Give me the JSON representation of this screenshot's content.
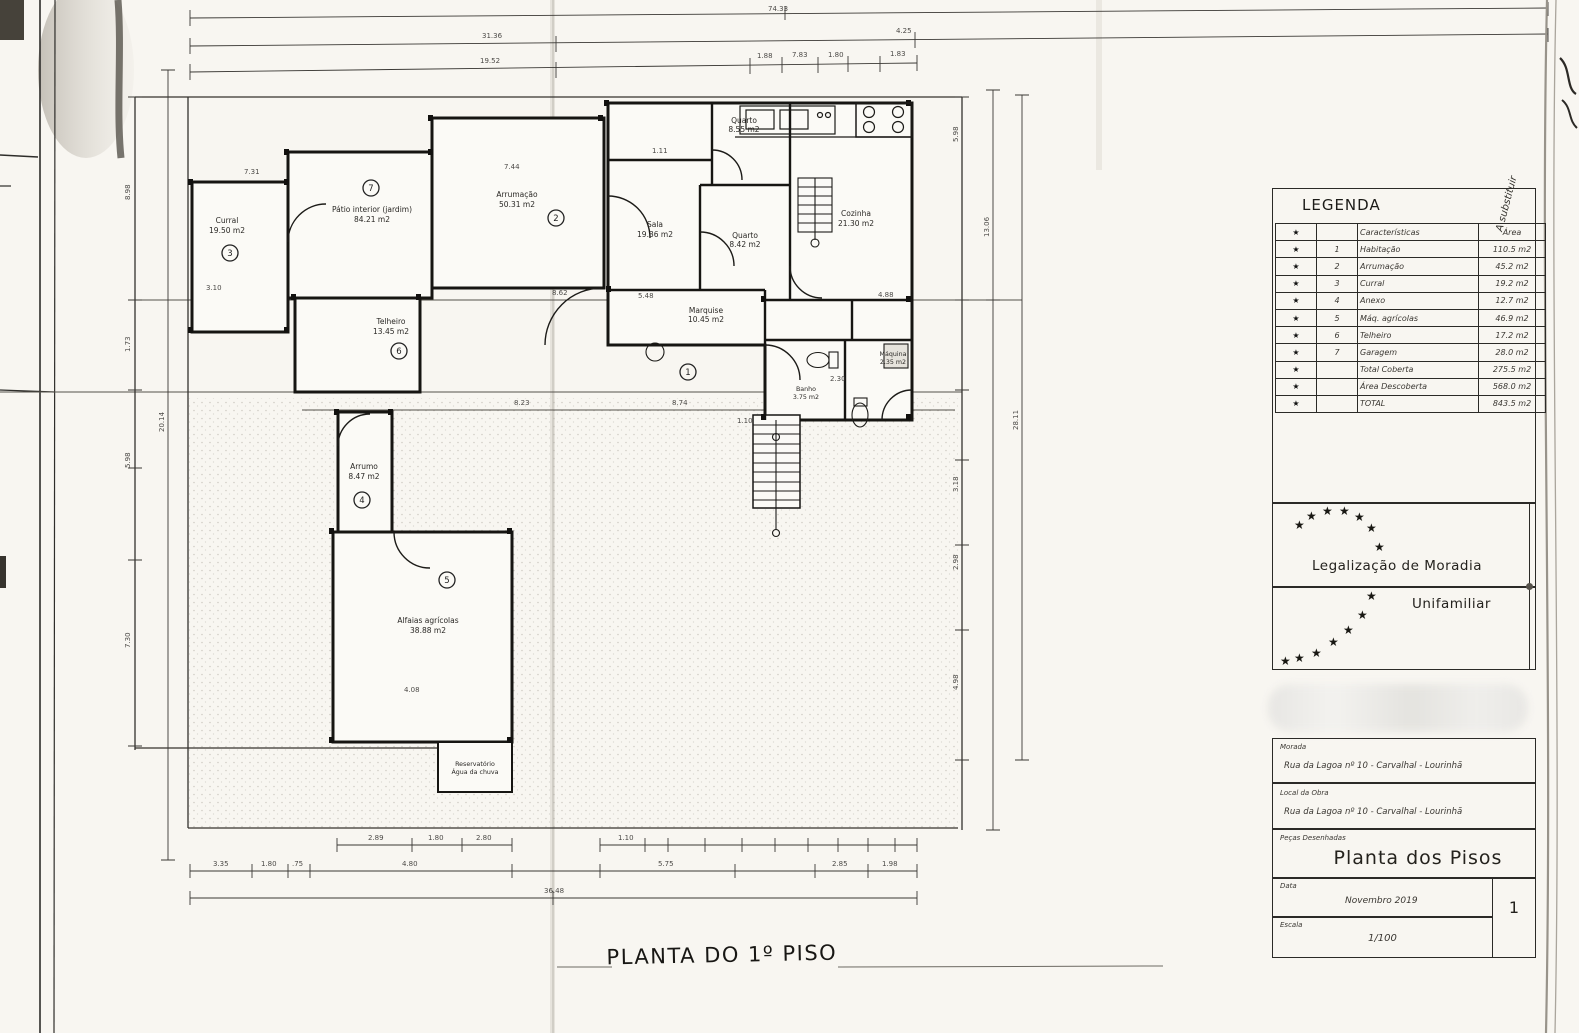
{
  "document": {
    "main_title": "PLANTA DO 1º PISO",
    "annotation": "A substituir"
  },
  "legend": {
    "title": "LEGENDA",
    "star": "★",
    "header": {
      "num": "",
      "name": "Características",
      "area": "Área"
    },
    "rows": [
      {
        "num": "1",
        "name": "Habitação",
        "area": "110.5 m2"
      },
      {
        "num": "2",
        "name": "Arrumação",
        "area": "45.2 m2"
      },
      {
        "num": "3",
        "name": "Curral",
        "area": "19.2 m2"
      },
      {
        "num": "4",
        "name": "Anexo",
        "area": "12.7 m2"
      },
      {
        "num": "5",
        "name": "Máq. agrícolas",
        "area": "46.9 m2"
      },
      {
        "num": "6",
        "name": "Telheiro",
        "area": "17.2 m2"
      },
      {
        "num": "7",
        "name": "Garagem",
        "area": "28.0 m2"
      },
      {
        "num": "",
        "name": "Total Coberta",
        "area": "275.5 m2"
      },
      {
        "num": "",
        "name": "Área Descoberta",
        "area": "568.0 m2"
      },
      {
        "num": "",
        "name": "TOTAL",
        "area": "843.5 m2"
      }
    ]
  },
  "stamp": {
    "star": "★",
    "line1": "Legalização de Moradia",
    "line2": "Unifamiliar"
  },
  "title_block": {
    "morada_label": "Morada",
    "morada_value": "Rua da Lagoa nº 10  -  Carvalhal  -  Lourinhã",
    "local_label": "Local da Obra",
    "local_value": "Rua da Lagoa nº 10  -  Carvalhal  -  Lourinhã",
    "pecas_label": "Peças Desenhadas",
    "pecas_value": "Planta dos Pisos",
    "data_label": "Data",
    "data_value": "Novembro 2019",
    "escala_label": "Escala",
    "escala_value": "1/100",
    "sheet_number": "1"
  },
  "rooms": [
    {
      "name": "Curral",
      "area": "19.50 m2",
      "num": "3"
    },
    {
      "name": "Pátio interior (jardim)",
      "area": "84.21 m2",
      "num": "7"
    },
    {
      "name": "Arrumação",
      "area": "50.31 m2",
      "num": "2"
    },
    {
      "name": "Telheiro",
      "area": "13.45 m2",
      "num": "6"
    },
    {
      "name": "Sala",
      "area": "19.36 m2"
    },
    {
      "name": "Quarto",
      "area": "8.55 m2"
    },
    {
      "name": "Quarto",
      "area": "8.42 m2"
    },
    {
      "name": "Cozinha",
      "area": "21.30 m2"
    },
    {
      "name": "Marquise",
      "area": "10.45 m2"
    },
    {
      "name": "Banho",
      "area": "3.75 m2"
    },
    {
      "name": "Máquina",
      "area": "2.35 m2"
    },
    {
      "name": "Arrumo",
      "area": "8.47 m2",
      "num": "4"
    },
    {
      "name": "Alfaias agrícolas",
      "area": "38.88 m2",
      "num": "5"
    },
    {
      "name": "Reservatório",
      "area": "Água da chuva"
    },
    {
      "num": "1"
    }
  ],
  "dims": {
    "top": [
      "74.33",
      "31.36",
      "4.25",
      "19.52",
      "1.88",
      "7.83",
      "1.80",
      "1.83"
    ],
    "left": [
      "8.98",
      "20.14",
      "1.73",
      "5.98",
      "7.30"
    ],
    "right": [
      "5.98",
      "13.06",
      "28.11",
      "3.18",
      "2.98",
      "4.98"
    ],
    "bottom": [
      "2.89",
      "1.80",
      "2.80",
      "3.35",
      "1.80",
      ".75",
      "4.80",
      "5.75",
      "1.10",
      "2.85",
      "1.98",
      "36.48"
    ],
    "inner": [
      "7.31",
      "7.44",
      "1.11",
      "8.62",
      "5.48",
      "4.88",
      "8.23",
      "8.74",
      "3.10",
      "2.30",
      "1.10",
      "4.08"
    ]
  }
}
